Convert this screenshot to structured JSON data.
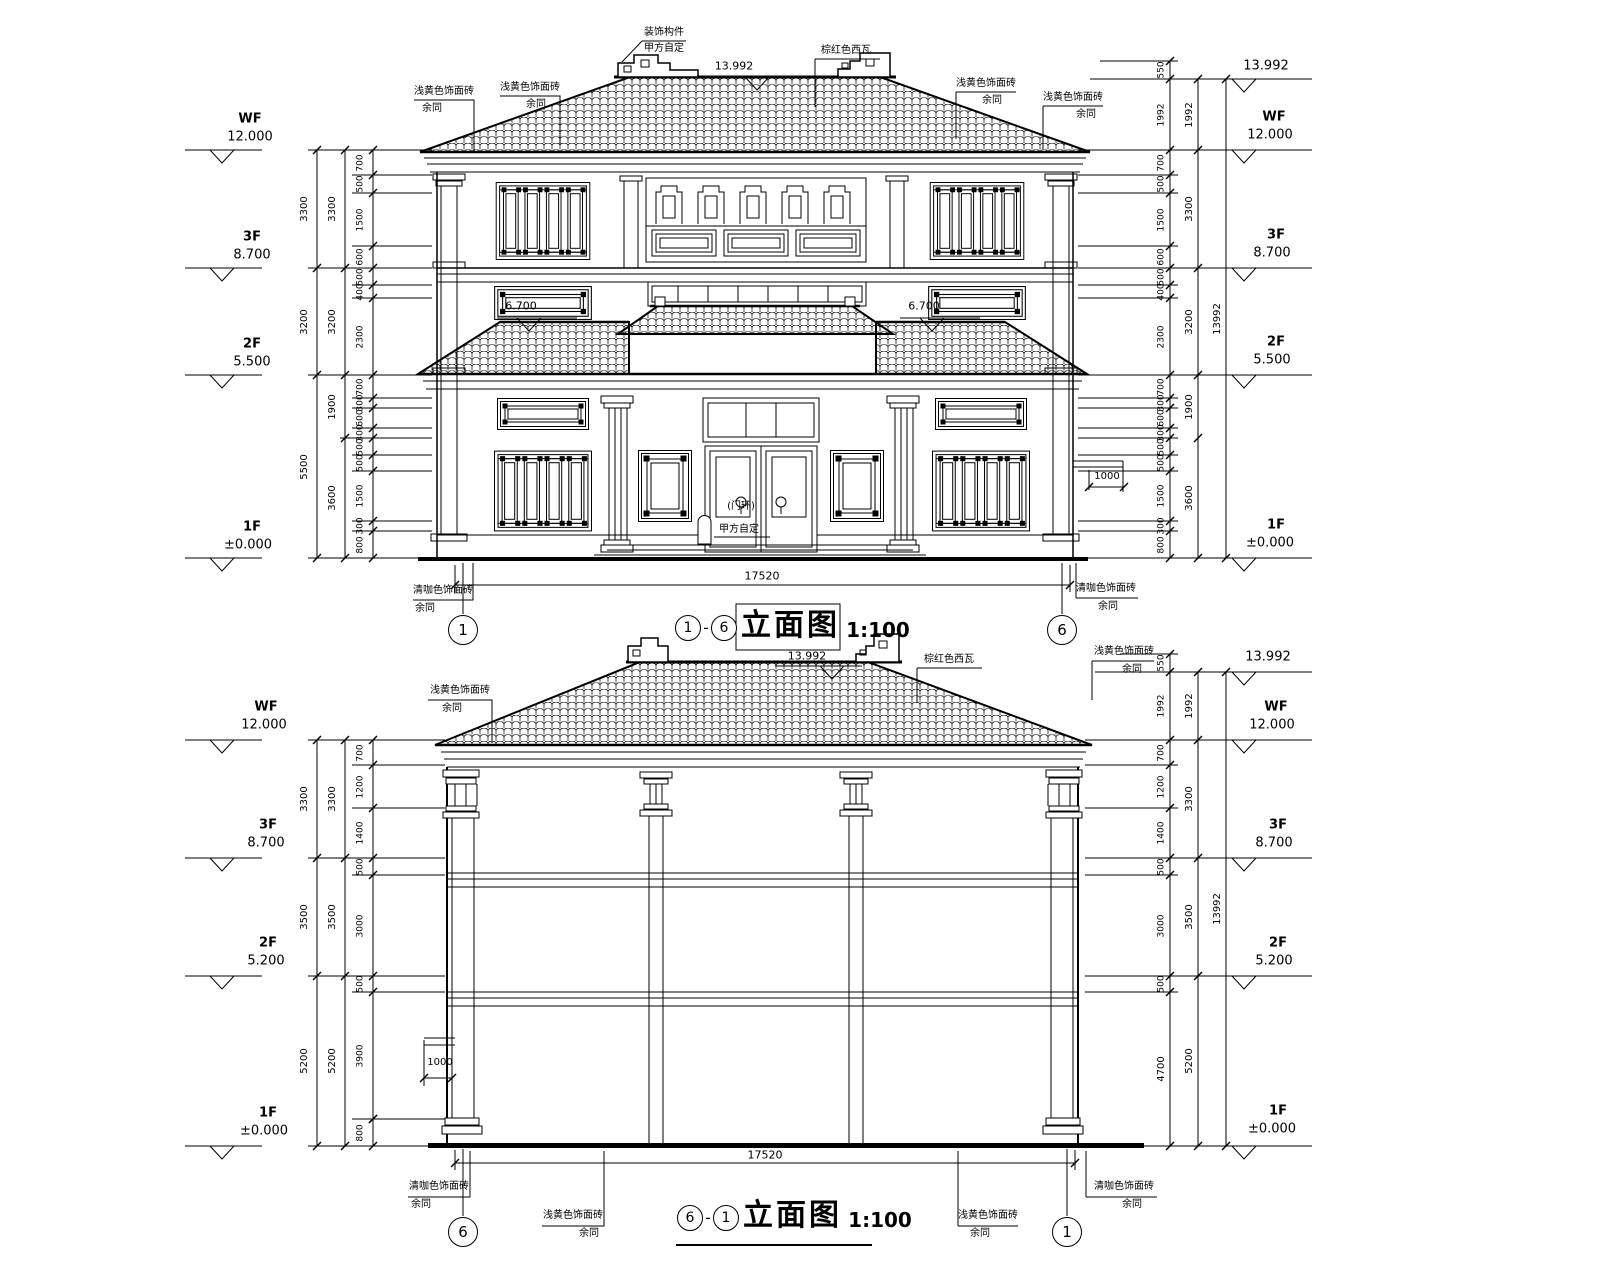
{
  "sheet": {
    "notes": {
      "deco_line1": "装饰构件",
      "deco_line2": "甲方自定",
      "roof_tile": "棕红色西瓦",
      "brick_yellow": "浅黄色饰面砖",
      "brick_dark": "清咖色饰面砖",
      "rest_same": "余同",
      "door_line1": "(门环)",
      "door_line2": "甲方自定"
    },
    "views": [
      {
        "axis_left": "1",
        "axis_right": "6",
        "title_text": "立面图",
        "title_sep": "-",
        "title_scale": "1:100",
        "overall_width": "17520",
        "ridge_elev": "13.992",
        "porch_elev": "6.700",
        "canopy_dim": "1000",
        "levels": [
          {
            "tag": "WF",
            "val": "12.000"
          },
          {
            "tag": "3F",
            "val": "8.700"
          },
          {
            "tag": "2F",
            "val": "5.500"
          },
          {
            "tag": "1F",
            "val": "±0.000"
          }
        ],
        "dims_outer": [
          "3300",
          "3200",
          "5500"
        ],
        "dims_mid": [
          "3300",
          "3200",
          "1900",
          "3600"
        ],
        "dims_inner": [
          "700",
          "500",
          "1500",
          "600",
          "500",
          "400",
          "2300",
          "700",
          "300",
          "600",
          "300",
          "500",
          "500",
          "1500",
          "300",
          "800"
        ],
        "dims_right_top": [
          "550",
          "1992"
        ],
        "dims_total": "13992"
      },
      {
        "axis_left": "6",
        "axis_right": "1",
        "title_text": "立面图",
        "title_sep": "-",
        "title_scale": "1:100",
        "overall_width": "17520",
        "ridge_elev": "13.992",
        "canopy_dim": "1000",
        "levels": [
          {
            "tag": "WF",
            "val": "12.000"
          },
          {
            "tag": "3F",
            "val": "8.700"
          },
          {
            "tag": "2F",
            "val": "5.200"
          },
          {
            "tag": "1F",
            "val": "±0.000"
          }
        ],
        "dims_outer": [
          "3300",
          "3500",
          "5200"
        ],
        "dims_inner": [
          "700",
          "1200",
          "1400",
          "500",
          "3000",
          "500",
          "3900",
          "800"
        ],
        "dims_right_top": [
          "550",
          "1992"
        ],
        "dims_right_bottom": "4700",
        "dims_total": "13992"
      }
    ]
  }
}
